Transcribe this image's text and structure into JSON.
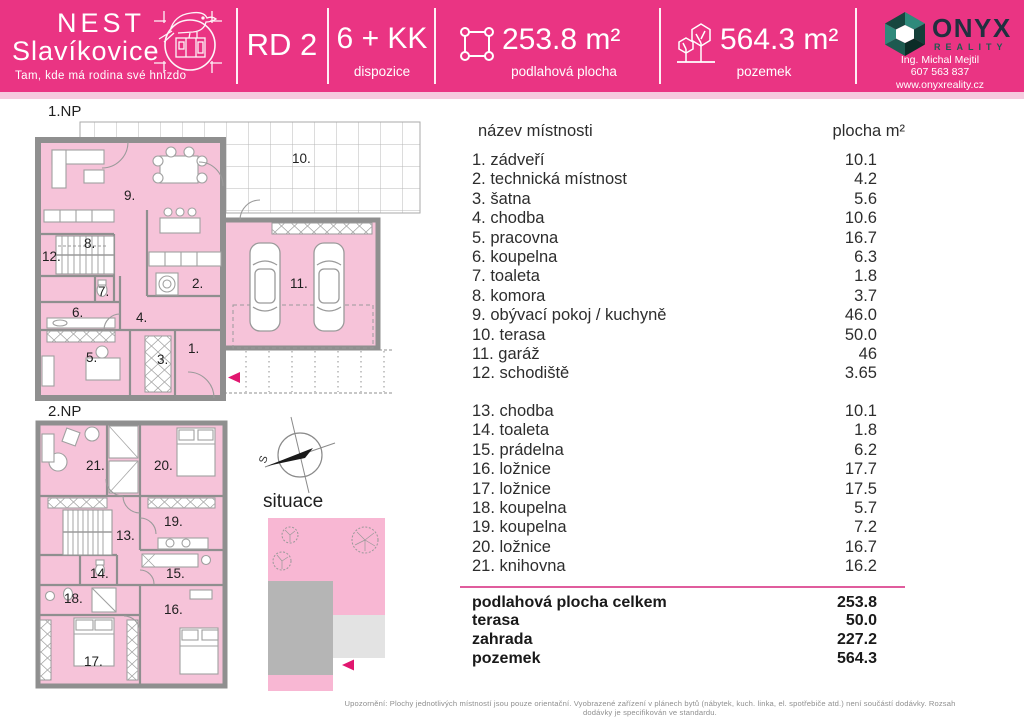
{
  "header": {
    "brand": {
      "line1": "NEST",
      "line2": "Slavíkovice",
      "tagline": "Tam, kde má rodina své hnízdo"
    },
    "unit_label": "RD 2",
    "blocks": {
      "dispozice": {
        "value": "6 + KK",
        "caption": "dispozice"
      },
      "floor_area": {
        "value": "253.8 m²",
        "caption": "podlahová plocha"
      },
      "plot_area": {
        "value": "564.3 m²",
        "caption": "pozemek"
      }
    },
    "agency": {
      "wordmark": "ONYX",
      "wordmark_sub": "REALITY",
      "agent": "Ing. Michal Mejtil",
      "phone": "607 563 837",
      "website": "www.onyxreality.cz"
    }
  },
  "plans": {
    "np1": {
      "title": "1.NP",
      "rooms": [
        "1.",
        "2.",
        "3.",
        "4.",
        "5.",
        "6.",
        "7.",
        "8.",
        "9.",
        "10.",
        "11.",
        "12."
      ]
    },
    "np2": {
      "title": "2.NP",
      "rooms": [
        "13.",
        "14.",
        "15.",
        "16.",
        "17.",
        "18.",
        "19.",
        "20.",
        "21."
      ]
    },
    "site": {
      "title": "situace",
      "compass_north": "S"
    }
  },
  "table": {
    "header": {
      "name": "název místnosti",
      "area": "plocha m²"
    },
    "floor1_rows": [
      {
        "name": "1. zádveří",
        "area": "10.1"
      },
      {
        "name": "2. technická místnost",
        "area": "4.2"
      },
      {
        "name": "3. šatna",
        "area": "5.6"
      },
      {
        "name": "4. chodba",
        "area": "10.6"
      },
      {
        "name": "5. pracovna",
        "area": "16.7"
      },
      {
        "name": "6. koupelna",
        "area": "6.3"
      },
      {
        "name": "7. toaleta",
        "area": "1.8"
      },
      {
        "name": "8. komora",
        "area": "3.7"
      },
      {
        "name": "9. obývací pokoj / kuchyně",
        "area": "46.0"
      },
      {
        "name": "10. terasa",
        "area": "50.0"
      },
      {
        "name": "11. garáž",
        "area": "46"
      },
      {
        "name": "12. schodiště",
        "area": "3.65"
      }
    ],
    "floor2_rows": [
      {
        "name": "13. chodba",
        "area": "10.1"
      },
      {
        "name": "14. toaleta",
        "area": "1.8"
      },
      {
        "name": "15. prádelna",
        "area": "6.2"
      },
      {
        "name": "16. ložnice",
        "area": "17.7"
      },
      {
        "name": "17. ložnice",
        "area": "17.5"
      },
      {
        "name": "18. koupelna",
        "area": "5.7"
      },
      {
        "name": "19. koupelna",
        "area": "7.2"
      },
      {
        "name": "20. ložnice",
        "area": "16.7"
      },
      {
        "name": "21. knihovna",
        "area": "16.2"
      }
    ]
  },
  "summary": {
    "rows": [
      {
        "label": "podlahová plocha celkem",
        "value": "253.8"
      },
      {
        "label": "terasa",
        "value": "50.0"
      },
      {
        "label": "zahrada",
        "value": "227.2"
      },
      {
        "label": "pozemek",
        "value": "564.3"
      }
    ]
  },
  "footer": {
    "disclaimer": "Upozornění: Plochy jednotlivých místností jsou pouze orientační. Vyobrazené zařízení v plánech bytů (nábytek, kuch. linka, el. spotřebiče atd.) není součástí dodávky. Rozsah dodávky je specifikován ve standardu."
  },
  "colors": {
    "brand_pink": "#ea3483",
    "room_pink": "#f6c3d9",
    "accent_arrow": "#e1166f"
  }
}
